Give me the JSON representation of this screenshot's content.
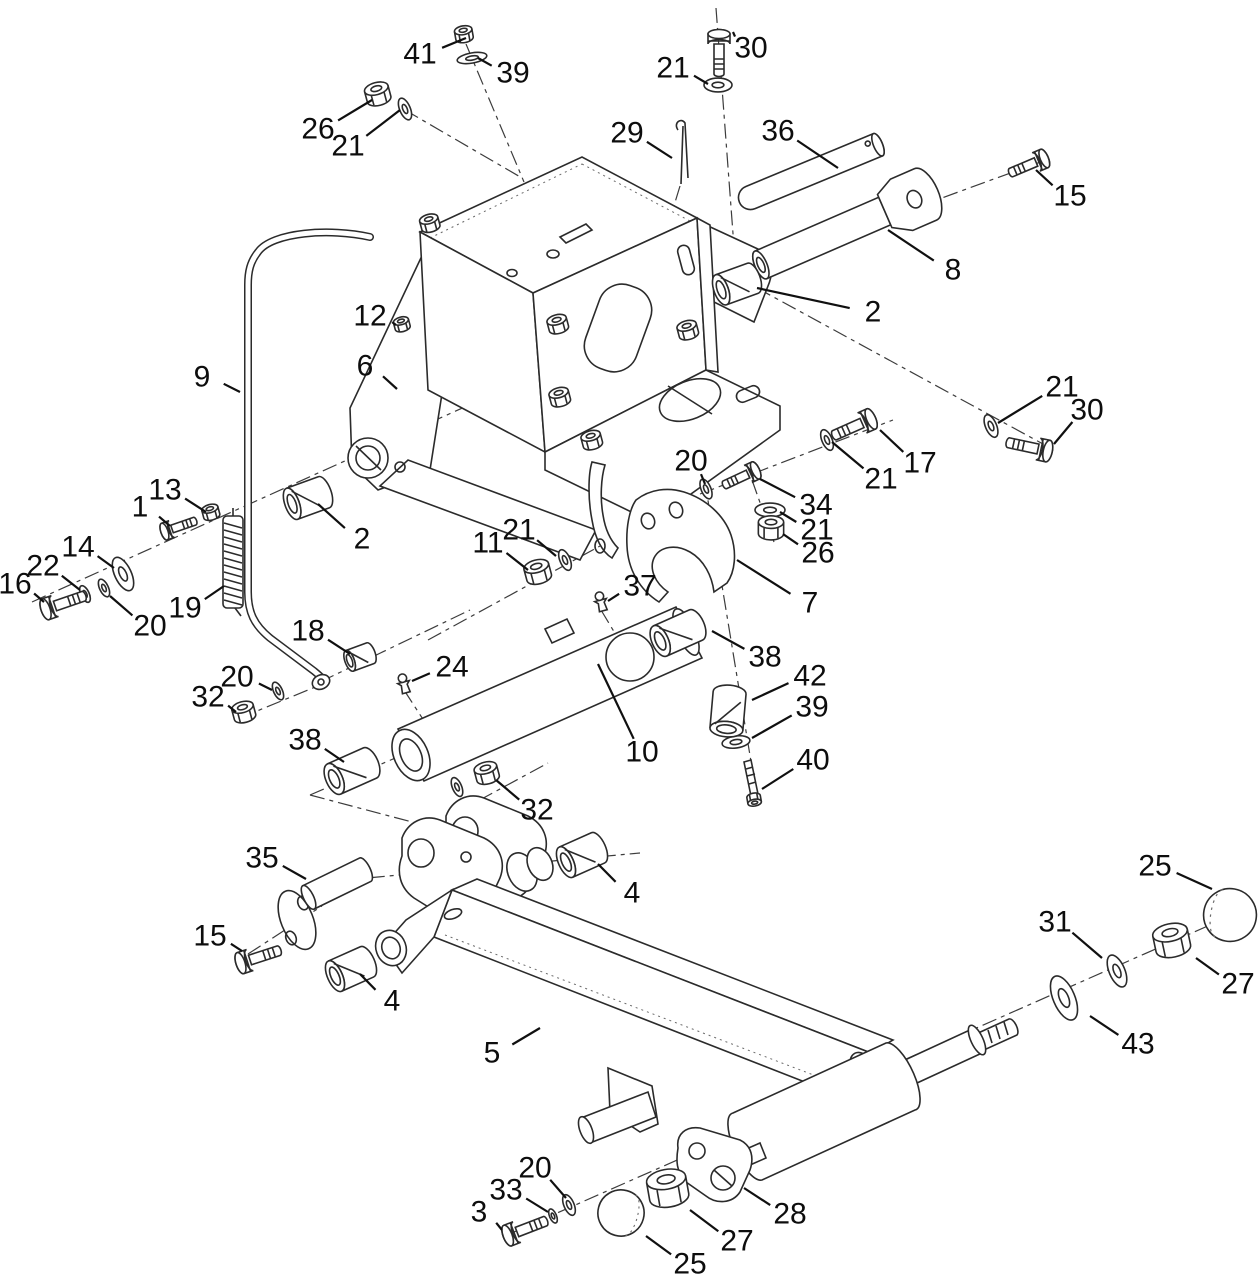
{
  "figure": {
    "type": "exploded-parts-diagram",
    "background": "#ffffff",
    "line_color": "#2b2b2b",
    "label_color": "#0d0d0d",
    "label_font_size": 30,
    "part_numbers_shown": [
      1,
      2,
      3,
      4,
      5,
      6,
      7,
      8,
      9,
      10,
      11,
      12,
      13,
      14,
      15,
      16,
      17,
      18,
      19,
      20,
      21,
      22,
      24,
      25,
      26,
      27,
      28,
      29,
      30,
      31,
      32,
      33,
      34,
      35,
      36,
      37,
      38,
      39,
      40,
      41,
      42,
      43
    ]
  },
  "callouts": [
    {
      "n": "41",
      "x": 420,
      "y": 54,
      "tx": 466,
      "ty": 38
    },
    {
      "n": "39",
      "x": 513,
      "y": 73,
      "tx": 478,
      "ty": 58
    },
    {
      "n": "26",
      "x": 318,
      "y": 129,
      "tx": 372,
      "ty": 100
    },
    {
      "n": "21",
      "x": 348,
      "y": 146,
      "tx": 400,
      "ty": 110
    },
    {
      "n": "29",
      "x": 627,
      "y": 133,
      "tx": 672,
      "ty": 158
    },
    {
      "n": "30",
      "x": 751,
      "y": 48,
      "tx": 733,
      "ty": 32
    },
    {
      "n": "21",
      "x": 673,
      "y": 68,
      "tx": 708,
      "ty": 84
    },
    {
      "n": "36",
      "x": 778,
      "y": 131,
      "tx": 838,
      "ty": 168
    },
    {
      "n": "15",
      "x": 1070,
      "y": 196,
      "tx": 1036,
      "ty": 170
    },
    {
      "n": "8",
      "x": 953,
      "y": 270,
      "tx": 888,
      "ty": 230
    },
    {
      "n": "2",
      "x": 873,
      "y": 312,
      "tx": 757,
      "ty": 288
    },
    {
      "n": "12",
      "x": 370,
      "y": 316,
      "tx": 396,
      "ty": 325
    },
    {
      "n": "6",
      "x": 365,
      "y": 366,
      "tx": 397,
      "ty": 389
    },
    {
      "n": "21",
      "x": 1062,
      "y": 387,
      "tx": 998,
      "ty": 423
    },
    {
      "n": "30",
      "x": 1087,
      "y": 410,
      "tx": 1054,
      "ty": 444
    },
    {
      "n": "17",
      "x": 920,
      "y": 463,
      "tx": 880,
      "ty": 430
    },
    {
      "n": "21",
      "x": 881,
      "y": 479,
      "tx": 832,
      "ty": 442
    },
    {
      "n": "9",
      "x": 202,
      "y": 377,
      "tx": 240,
      "ty": 392
    },
    {
      "n": "13",
      "x": 165,
      "y": 490,
      "tx": 206,
      "ty": 512
    },
    {
      "n": "1",
      "x": 140,
      "y": 507,
      "tx": 170,
      "ty": 526
    },
    {
      "n": "14",
      "x": 78,
      "y": 547,
      "tx": 114,
      "ty": 568
    },
    {
      "n": "22",
      "x": 43,
      "y": 566,
      "tx": 80,
      "ty": 590
    },
    {
      "n": "16",
      "x": 15,
      "y": 584,
      "tx": 44,
      "ty": 602
    },
    {
      "n": "20",
      "x": 150,
      "y": 626,
      "tx": 110,
      "ty": 596
    },
    {
      "n": "19",
      "x": 185,
      "y": 608,
      "tx": 224,
      "ty": 586
    },
    {
      "n": "2",
      "x": 362,
      "y": 539,
      "tx": 318,
      "ty": 504
    },
    {
      "n": "18",
      "x": 308,
      "y": 631,
      "tx": 350,
      "ty": 654
    },
    {
      "n": "20",
      "x": 237,
      "y": 677,
      "tx": 272,
      "ty": 690
    },
    {
      "n": "32",
      "x": 208,
      "y": 697,
      "tx": 236,
      "ty": 712
    },
    {
      "n": "11",
      "x": 488,
      "y": 543,
      "tx": 528,
      "ty": 570
    },
    {
      "n": "21",
      "x": 519,
      "y": 530,
      "tx": 556,
      "ty": 556
    },
    {
      "n": "37",
      "x": 640,
      "y": 586,
      "tx": 608,
      "ty": 601
    },
    {
      "n": "24",
      "x": 452,
      "y": 667,
      "tx": 412,
      "ty": 681
    },
    {
      "n": "20",
      "x": 691,
      "y": 461,
      "tx": 705,
      "ty": 484
    },
    {
      "n": "34",
      "x": 816,
      "y": 505,
      "tx": 760,
      "ty": 479
    },
    {
      "n": "21",
      "x": 817,
      "y": 530,
      "tx": 780,
      "ty": 512
    },
    {
      "n": "26",
      "x": 818,
      "y": 553,
      "tx": 783,
      "ty": 534
    },
    {
      "n": "7",
      "x": 810,
      "y": 603,
      "tx": 737,
      "ty": 560
    },
    {
      "n": "38",
      "x": 765,
      "y": 657,
      "tx": 712,
      "ty": 631
    },
    {
      "n": "42",
      "x": 810,
      "y": 676,
      "tx": 752,
      "ty": 700
    },
    {
      "n": "39",
      "x": 812,
      "y": 707,
      "tx": 752,
      "ty": 738
    },
    {
      "n": "40",
      "x": 813,
      "y": 760,
      "tx": 762,
      "ty": 789
    },
    {
      "n": "10",
      "x": 642,
      "y": 752,
      "tx": 598,
      "ty": 664
    },
    {
      "n": "32",
      "x": 537,
      "y": 810,
      "tx": 496,
      "ty": 780
    },
    {
      "n": "38",
      "x": 305,
      "y": 740,
      "tx": 344,
      "ty": 762
    },
    {
      "n": "35",
      "x": 262,
      "y": 858,
      "tx": 306,
      "ty": 879
    },
    {
      "n": "15",
      "x": 210,
      "y": 936,
      "tx": 242,
      "ty": 951
    },
    {
      "n": "4",
      "x": 632,
      "y": 893,
      "tx": 598,
      "ty": 864
    },
    {
      "n": "4",
      "x": 392,
      "y": 1001,
      "tx": 360,
      "ty": 974
    },
    {
      "n": "5",
      "x": 492,
      "y": 1053,
      "tx": 540,
      "ty": 1028
    },
    {
      "n": "20",
      "x": 535,
      "y": 1168,
      "tx": 566,
      "ty": 1198
    },
    {
      "n": "33",
      "x": 506,
      "y": 1190,
      "tx": 548,
      "ty": 1212
    },
    {
      "n": "3",
      "x": 479,
      "y": 1212,
      "tx": 502,
      "ty": 1230
    },
    {
      "n": "25",
      "x": 690,
      "y": 1264,
      "tx": 646,
      "ty": 1236
    },
    {
      "n": "27",
      "x": 737,
      "y": 1241,
      "tx": 690,
      "ty": 1210
    },
    {
      "n": "28",
      "x": 790,
      "y": 1214,
      "tx": 744,
      "ty": 1188
    },
    {
      "n": "25",
      "x": 1155,
      "y": 866,
      "tx": 1212,
      "ty": 889
    },
    {
      "n": "31",
      "x": 1055,
      "y": 922,
      "tx": 1102,
      "ty": 958
    },
    {
      "n": "27",
      "x": 1238,
      "y": 984,
      "tx": 1196,
      "ty": 958
    },
    {
      "n": "43",
      "x": 1138,
      "y": 1044,
      "tx": 1090,
      "ty": 1016
    }
  ]
}
